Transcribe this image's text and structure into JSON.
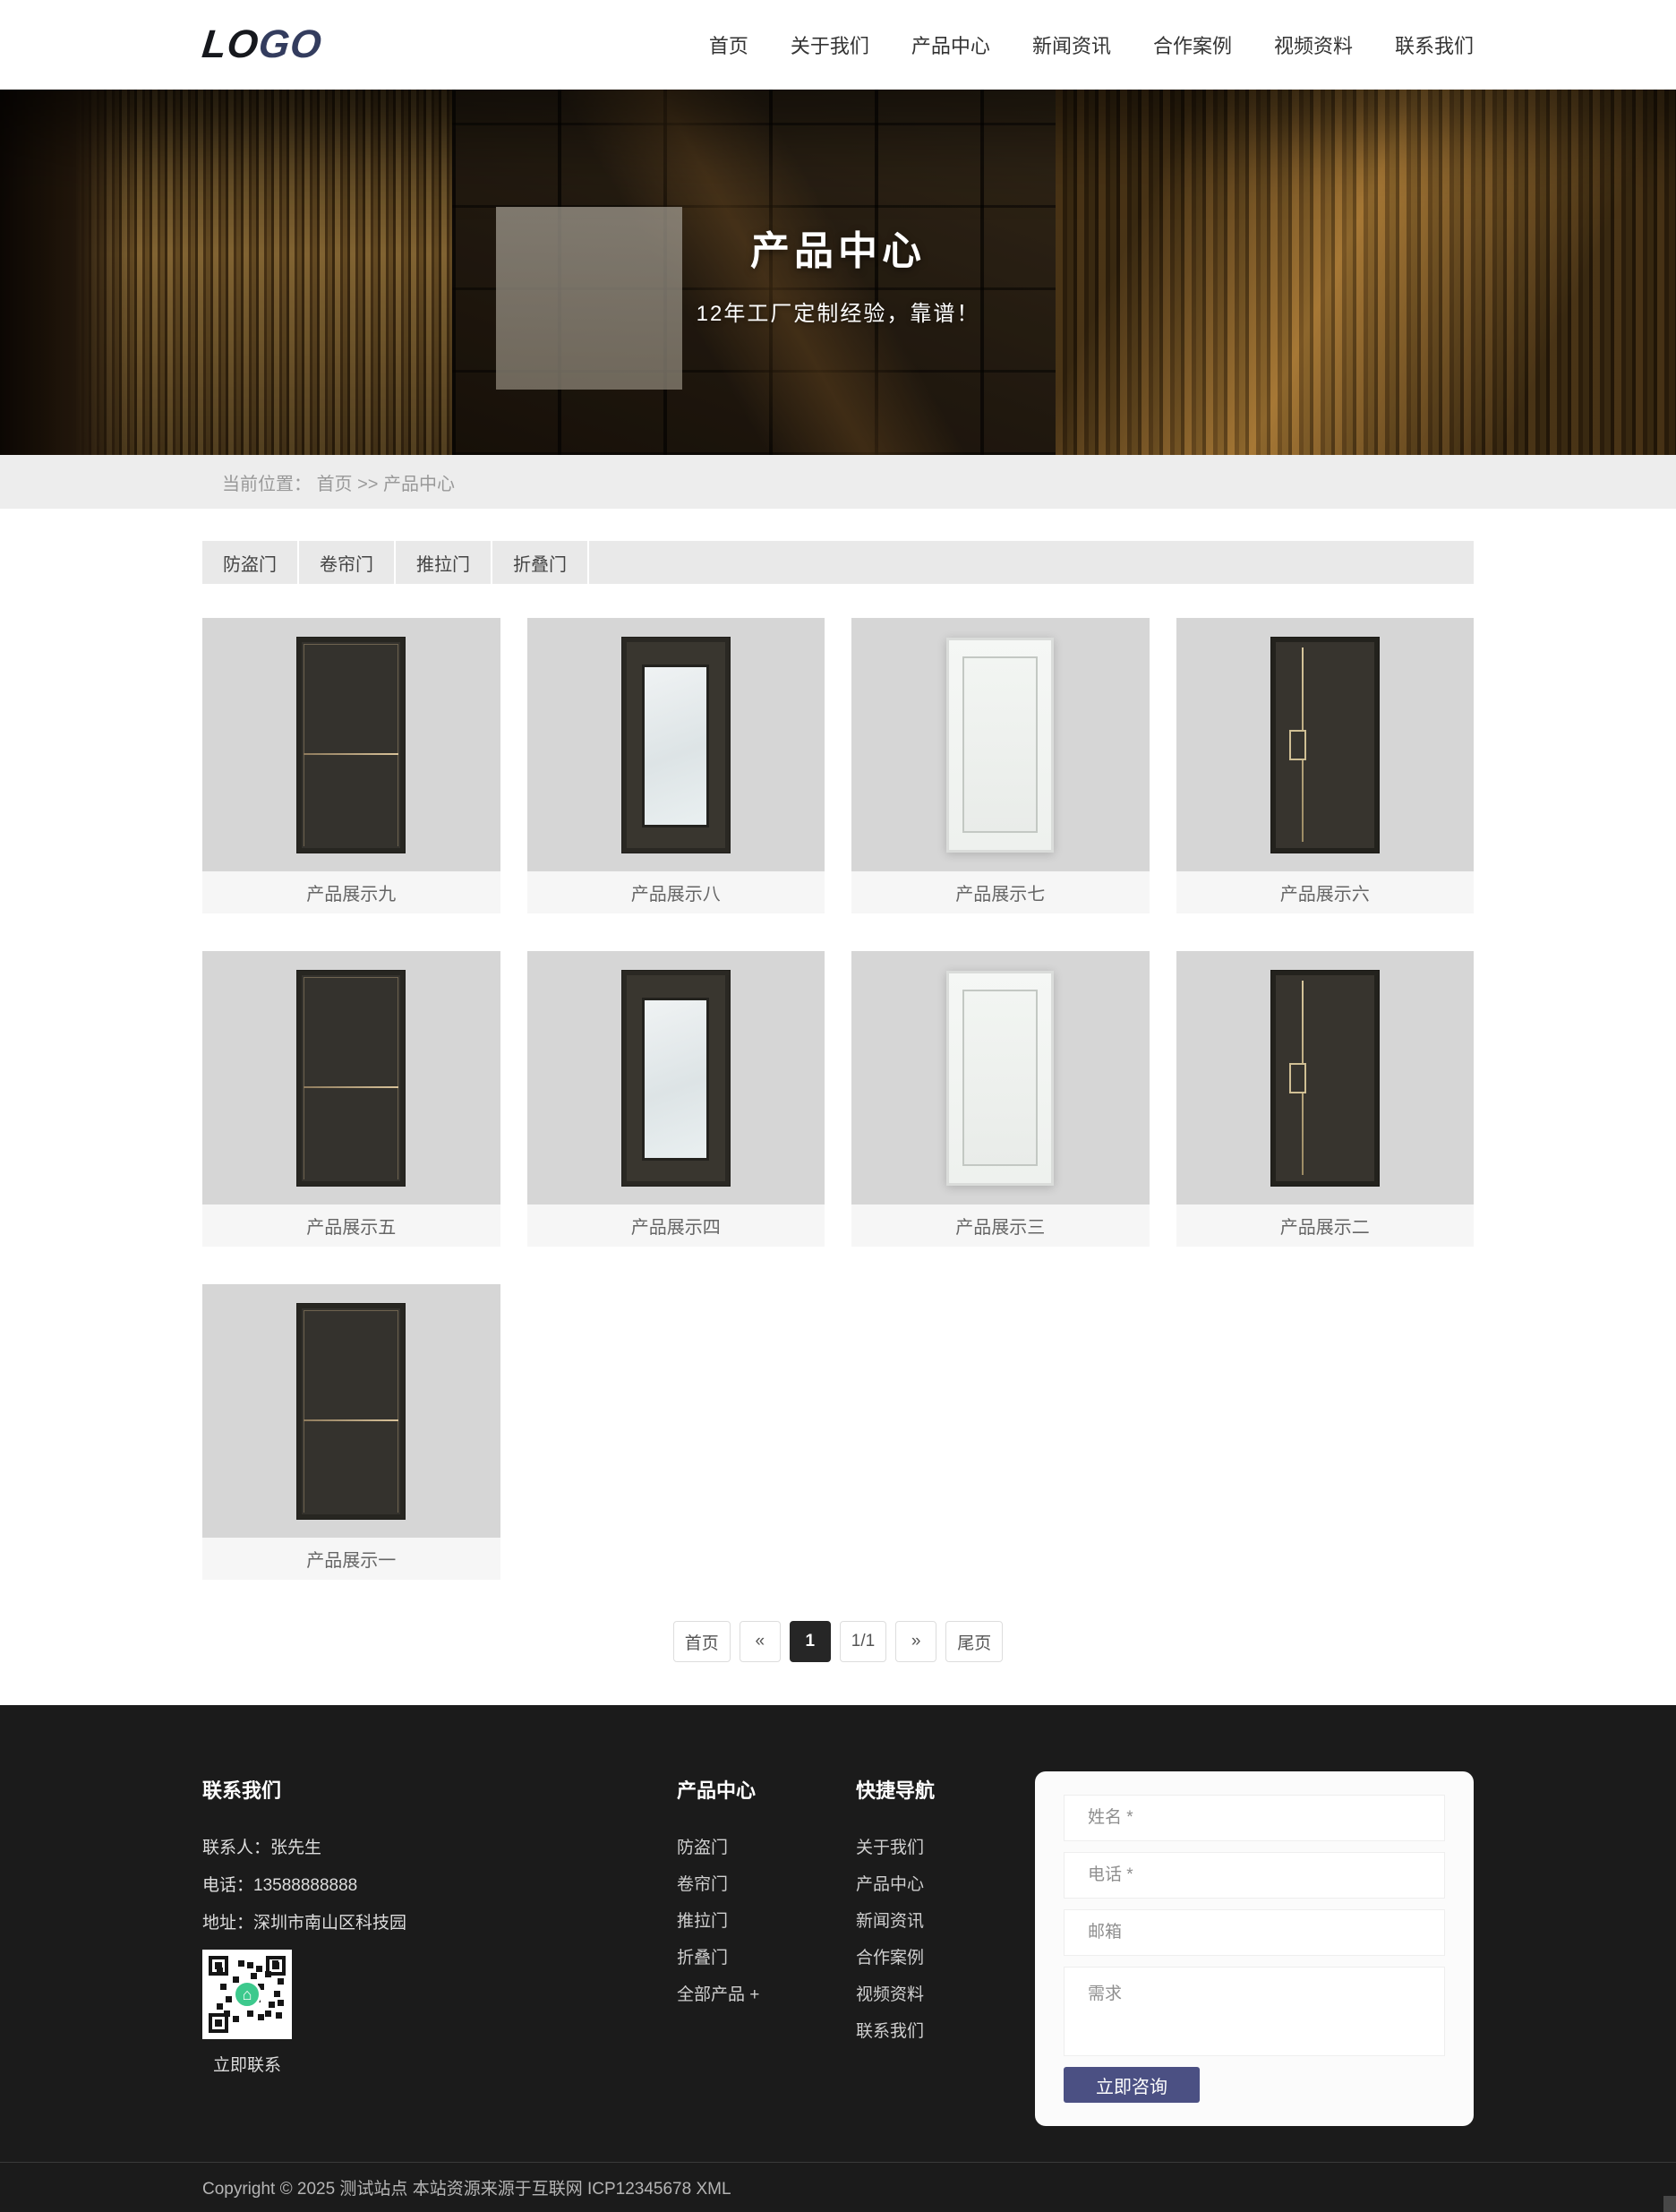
{
  "colors": {
    "accent_button": "#4b5083",
    "footer_background": "#1b1b1b",
    "qr_home_green": "#3dc98d",
    "pagination_active": "#262626"
  },
  "header": {
    "logo_part1": "LO",
    "logo_part2": "GO",
    "nav": [
      "首页",
      "关于我们",
      "产品中心",
      "新闻资讯",
      "合作案例",
      "视频资料",
      "联系我们"
    ]
  },
  "hero": {
    "title": "产品中心",
    "subtitle": "12年工厂定制经验，靠谱！"
  },
  "breadcrumb": {
    "label": "当前位置：",
    "home": "首页",
    "separator": ">>",
    "current": "产品中心"
  },
  "category_tabs": [
    "防盗门",
    "卷帘门",
    "推拉门",
    "折叠门"
  ],
  "products": {
    "items": [
      {
        "label": "产品展示九",
        "kind": "dark-split"
      },
      {
        "label": "产品展示八",
        "kind": "glass"
      },
      {
        "label": "产品展示七",
        "kind": "white"
      },
      {
        "label": "产品展示六",
        "kind": "dark-notch"
      },
      {
        "label": "产品展示五",
        "kind": "dark-split"
      },
      {
        "label": "产品展示四",
        "kind": "glass"
      },
      {
        "label": "产品展示三",
        "kind": "white"
      },
      {
        "label": "产品展示二",
        "kind": "dark-notch"
      },
      {
        "label": "产品展示一",
        "kind": "dark-split"
      }
    ]
  },
  "pagination": {
    "first": "首页",
    "prev": "«",
    "current": "1",
    "info": "1/1",
    "next": "»",
    "last": "尾页"
  },
  "footer": {
    "contact": {
      "title": "联系我们",
      "person": "联系人：张先生",
      "phone": "电话：13588888888",
      "address": "地址：深圳市南山区科技园",
      "qr_label": "立即联系"
    },
    "product_center": {
      "title": "产品中心",
      "links": [
        "防盗门",
        "卷帘门",
        "推拉门",
        "折叠门",
        "全部产品 +"
      ]
    },
    "quick_nav": {
      "title": "快捷导航",
      "links": [
        "关于我们",
        "产品中心",
        "新闻资讯",
        "合作案例",
        "视频资料",
        "联系我们"
      ]
    },
    "form": {
      "name_placeholder": "姓名 *",
      "phone_placeholder": "电话 *",
      "email_placeholder": "邮箱",
      "message_placeholder": "需求",
      "submit_label": "立即咨询"
    },
    "copyright": "Copyright © 2025 测试站点 本站资源来源于互联网 ICP12345678 XML"
  }
}
